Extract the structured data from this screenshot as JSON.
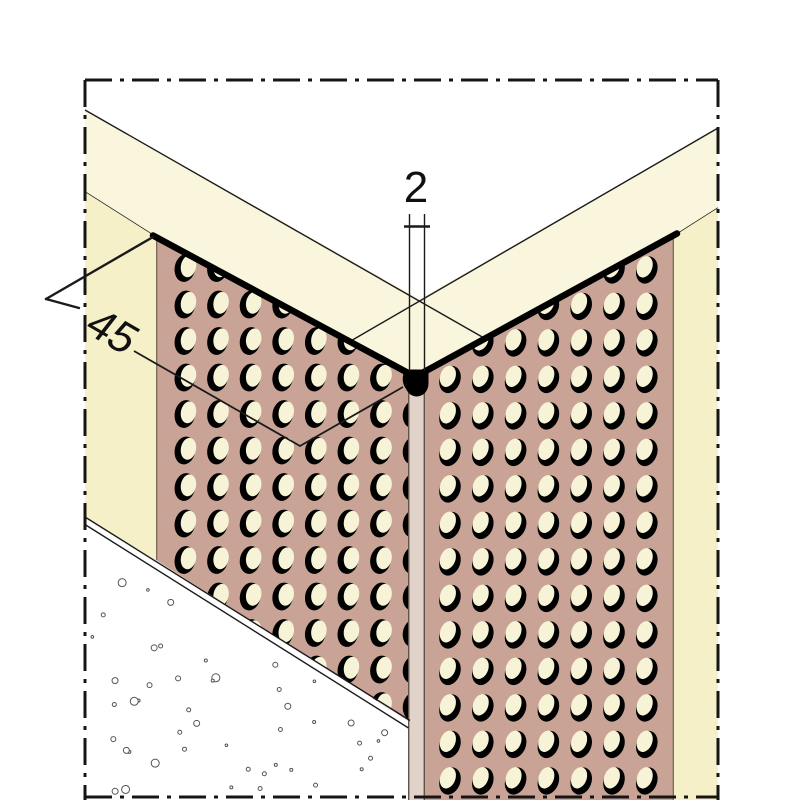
{
  "drawing": {
    "kind": "corner-bead-profile-detail",
    "labels": {
      "nose_width": "2",
      "wing_width": "45"
    },
    "colors": {
      "background": "#ffffff",
      "top_surface_band": "#f9f6dd",
      "base_wall": "#f6f0c8",
      "profile_wing": "#c9a496",
      "hole_fill": "#f7f3d6",
      "hole_shadow": "#000000",
      "nose_strip": "#e1d3c9",
      "nose": "#000000",
      "outline": "#1a1a1a",
      "edge_thick": "#000000",
      "wing_side_line": "#7a6a58",
      "strip_side_line": "#5f5248",
      "border_dashdot": "#151515",
      "stipple": "#555555",
      "dimension_line": "#1a1a1a",
      "text": "#111111"
    }
  }
}
